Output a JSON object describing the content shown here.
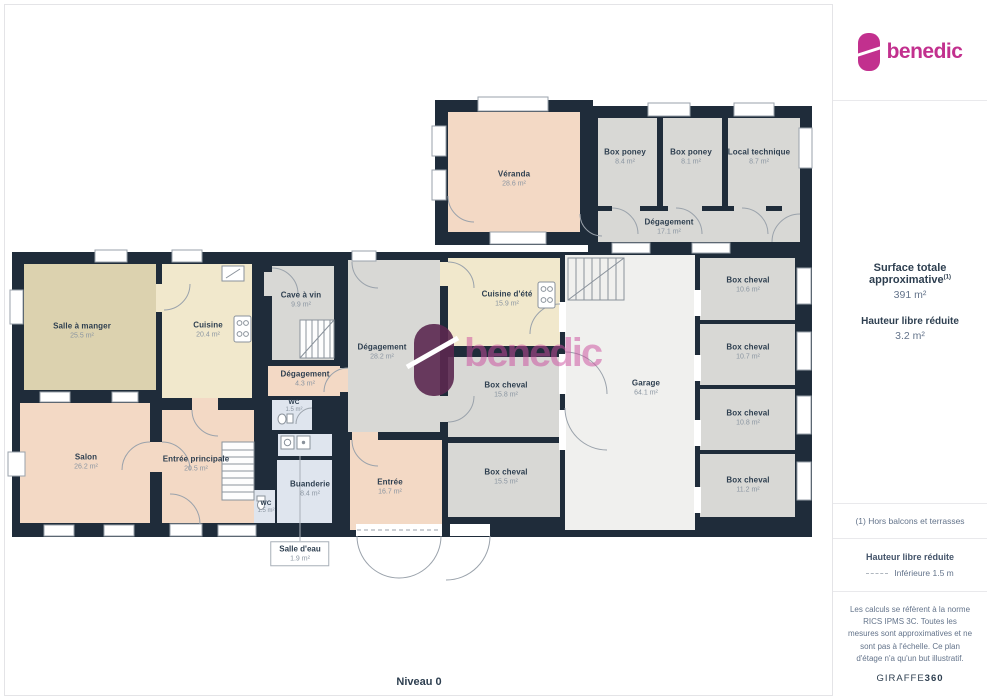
{
  "brand": {
    "logo_text": "benedic",
    "accent_color": "#c2308e"
  },
  "watermark": {
    "text": "benedic"
  },
  "sidebar": {
    "surface_label": "Surface totale approximative",
    "surface_note_ref": "(1)",
    "surface_value": "391 m²",
    "height_label": "Hauteur libre réduite",
    "height_value": "3.2 m²",
    "note": "(1) Hors balcons et terrasses",
    "legend_title": "Hauteur libre réduite",
    "legend_item": "Inférieure 1.5 m",
    "disclaimer": "Les calculs se réfèrent à la norme RICS IPMS 3C. Toutes les mesures sont approximatives et ne sont pas à l'échelle. Ce plan d'étage n'a qu'un but illustratif.",
    "brand_name": "GIRAFFE",
    "brand_suffix": "360"
  },
  "plan": {
    "level_label": "Niveau 0",
    "colors": {
      "wall": "#1f2c3a",
      "living_peach": "#f3d9c5",
      "dining_tan": "#dcd2af",
      "kitchen_cream": "#f1e8cc",
      "utility_gray": "#d8d8d5",
      "garage_light": "#f0f0ee",
      "water_blue": "#dfe5ee",
      "watermark_pink": "#cc4d9e"
    },
    "rooms": {
      "veranda": {
        "name": "Véranda",
        "area": "28.6 m²"
      },
      "box_poney_1": {
        "name": "Box poney",
        "area": "8.4 m²"
      },
      "box_poney_2": {
        "name": "Box poney",
        "area": "8.1 m²"
      },
      "local_technique": {
        "name": "Local technique",
        "area": "8.7 m²"
      },
      "degagement_17": {
        "name": "Dégagement",
        "area": "17.1 m²"
      },
      "salle_a_manger": {
        "name": "Salle à manger",
        "area": "25.5 m²"
      },
      "cuisine": {
        "name": "Cuisine",
        "area": "20.4 m²"
      },
      "cave_a_vin": {
        "name": "Cave à vin",
        "area": "9.9 m²"
      },
      "degagement_4": {
        "name": "Dégagement",
        "area": "4.3 m²"
      },
      "wc_1": {
        "name": "WC",
        "area": "1.5 m²"
      },
      "salon": {
        "name": "Salon",
        "area": "26.2 m²"
      },
      "entree_principale": {
        "name": "Entrée principale",
        "area": "20.5 m²"
      },
      "degagement_28": {
        "name": "Dégagement",
        "area": "28.2 m²"
      },
      "salle_deau": {
        "name": "Salle d'eau",
        "area": "1.9 m²"
      },
      "buanderie": {
        "name": "Buanderie",
        "area": "8.4 m²"
      },
      "wc_2": {
        "name": "WC",
        "area": "1.5 m²"
      },
      "entree": {
        "name": "Entrée",
        "area": "16.7 m²"
      },
      "cuisine_ete": {
        "name": "Cuisine d'été",
        "area": "15.9 m²"
      },
      "box_cheval_a": {
        "name": "Box cheval",
        "area": "15.8 m²"
      },
      "box_cheval_b": {
        "name": "Box cheval",
        "area": "15.5 m²"
      },
      "garage": {
        "name": "Garage",
        "area": "64.1 m²"
      },
      "box_cheval_c": {
        "name": "Box cheval",
        "area": "10.6 m²"
      },
      "box_cheval_d": {
        "name": "Box cheval",
        "area": "10.7 m²"
      },
      "box_cheval_e": {
        "name": "Box cheval",
        "area": "11.2 m²"
      },
      "box_cheval_f": {
        "name": "Box cheval",
        "area": "10.8 m²"
      }
    }
  }
}
